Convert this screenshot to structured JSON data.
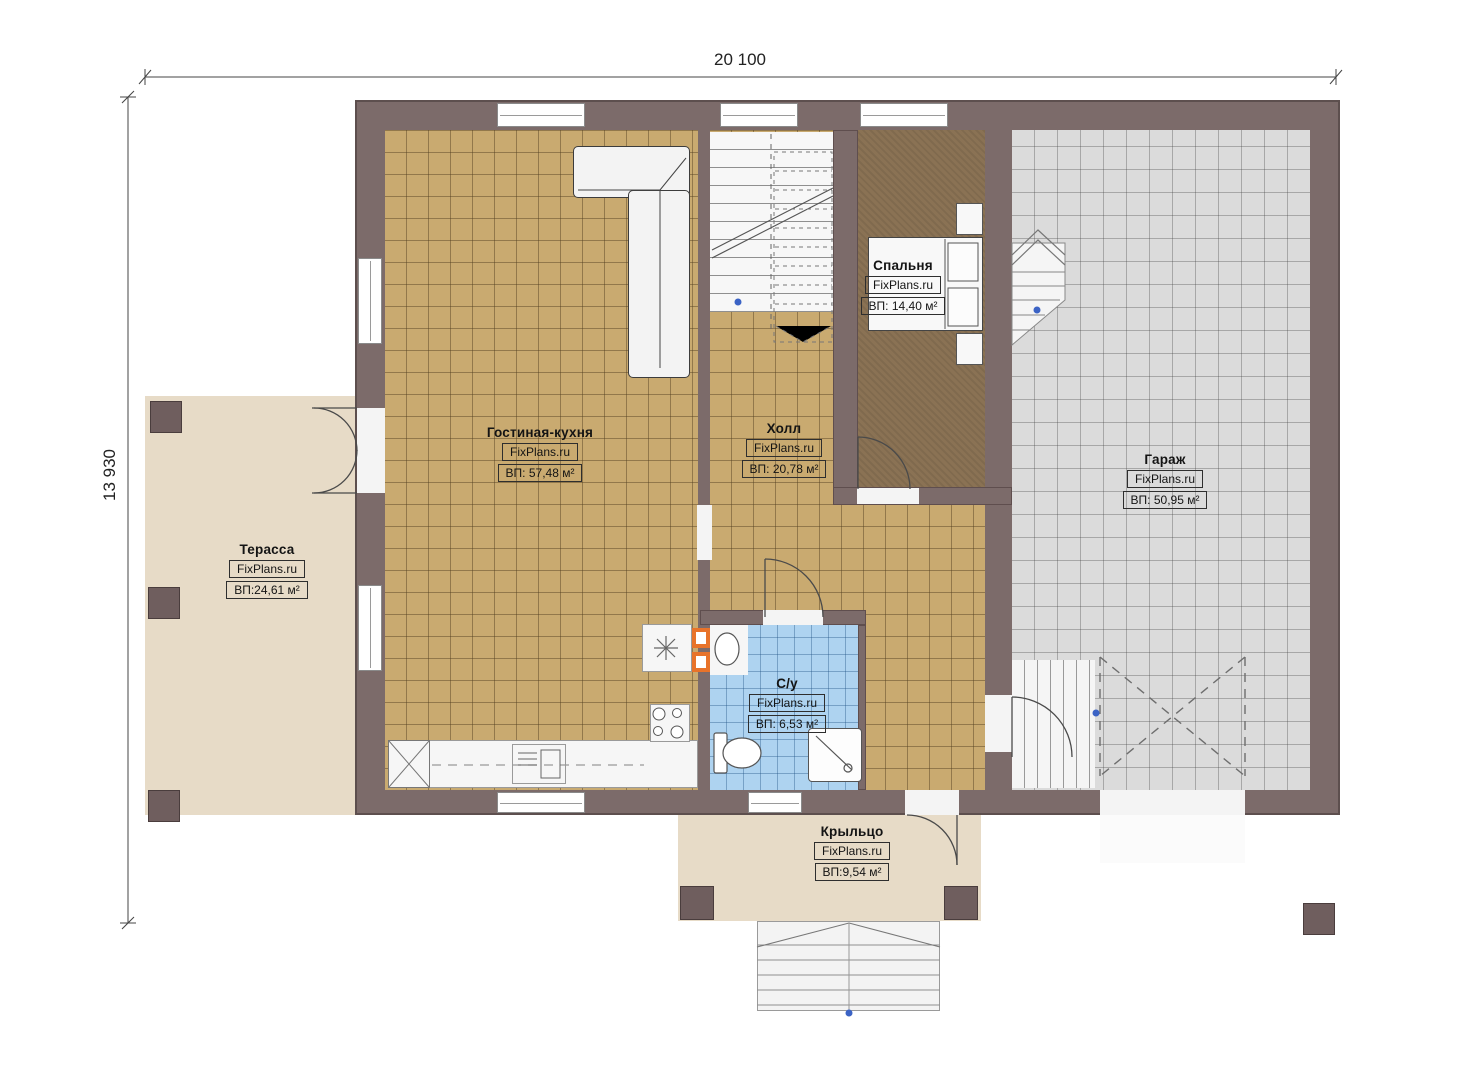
{
  "title": "Floor plan first floor",
  "brand": "FixPlans.ru",
  "dimensions": {
    "width_label": "20 100",
    "height_label": "13 930"
  },
  "rooms": [
    {
      "id": "living",
      "name": "Гостиная-кухня",
      "brand": "FixPlans.ru",
      "area": "ВП: 57,48 м²"
    },
    {
      "id": "hall",
      "name": "Холл",
      "brand": "FixPlans.ru",
      "area": "ВП: 20,78 м²"
    },
    {
      "id": "bedroom",
      "name": "Спальня",
      "brand": "FixPlans.ru",
      "area": "ВП: 14,40 м²"
    },
    {
      "id": "garage",
      "name": "Гараж",
      "brand": "FixPlans.ru",
      "area": "ВП: 50,95 м²"
    },
    {
      "id": "terrace",
      "name": "Терасса",
      "brand": "FixPlans.ru",
      "area": "ВП:24,61 м²"
    },
    {
      "id": "bathroom",
      "name": "С/у",
      "brand": "FixPlans.ru",
      "area": "ВП: 6,53 м²"
    },
    {
      "id": "porch",
      "name": "Крыльцо",
      "brand": "FixPlans.ru",
      "area": "ВП:9,54 м²"
    }
  ],
  "colors": {
    "wall": "#7c6b6a",
    "tile_tan": "#c9aa70",
    "tile_gray": "#dbdbdb",
    "tile_blue": "#aed3f0",
    "bedroom_floor": "#8a7254",
    "deck": "#e7dbc7",
    "accent_orange": "#e8732a",
    "dot_blue": "#3b63c5"
  }
}
